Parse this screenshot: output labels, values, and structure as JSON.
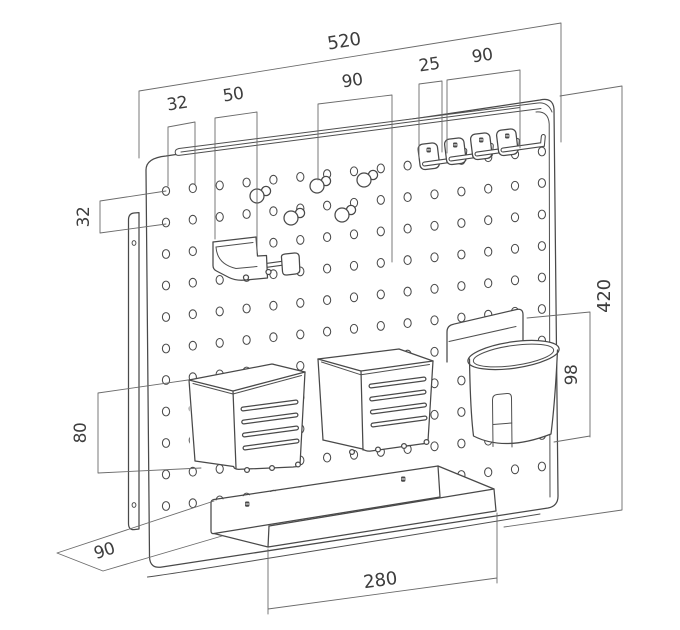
{
  "drawing": {
    "type": "technical-dimension-diagram",
    "subject": "pegboard wall organizer with hooks, pegs, baskets, cup holder and shelf",
    "dimensions": {
      "overall_width": "520",
      "overall_height": "420",
      "hole_offset_top_left": "32",
      "tool_holder_width": "50",
      "peg_group_span": "90",
      "hook_spacing": "25",
      "hook_group_span": "90",
      "hole_row_spacing": "32",
      "basket_height": "80",
      "cup_holder_height": "98",
      "side_depth": "90",
      "shelf_length": "280"
    }
  }
}
